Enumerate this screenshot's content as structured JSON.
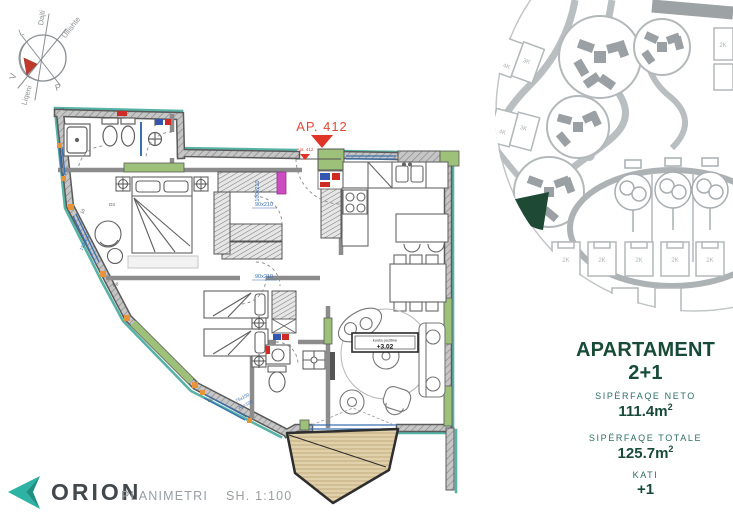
{
  "compass": {
    "axis_labels": [
      "Dajti",
      "Ullishte",
      "Liqeni"
    ],
    "cardinal_letters": [
      "L",
      "V",
      "P"
    ]
  },
  "floor_plan": {
    "unit_callout": "AP. 412",
    "unit_callout_small": "Apt. 412",
    "level_caption": "kuota pozitive",
    "level_value": "+3.02",
    "door_dim_1": "90x210",
    "door_dim_2": "90x210",
    "entry_dim": "100x210",
    "window_dim_1": "75x150",
    "window_dim_2": "Ap=100",
    "window_dim_3": "150x120",
    "window_id_a": "D3",
    "window_id_b": "D8",
    "window_id_c": "D9",
    "window_id_d": "10"
  },
  "site_plan": {
    "lot_labels": [
      "4K",
      "3K",
      "4K",
      "3K"
    ],
    "house_labels": [
      "2K",
      "2K",
      "2K",
      "2K",
      "2K",
      "2K",
      "2K"
    ]
  },
  "info_panel": {
    "title": "APARTAMENT 2+1",
    "net_area_label": "SIPËRFAQE NETO",
    "net_area_value": "111.4m",
    "net_area_sup": "2",
    "total_area_label": "SIPËRFAQE TOTALE",
    "total_area_value": "125.7m",
    "total_area_sup": "2",
    "floor_label": "KATI",
    "floor_value": "+1"
  },
  "footer": {
    "brand": "ORION",
    "doc_label": "PLANIMETRI",
    "scale_label": "SH. 1:100"
  },
  "colors": {
    "accent_teal": "#2cb3a4",
    "heading_green": "#174a37",
    "label_green": "#2f6e60",
    "exterior_teal": "#56b3a6",
    "highlight_green": "#1d4935",
    "callout_red": "#e0493c"
  }
}
